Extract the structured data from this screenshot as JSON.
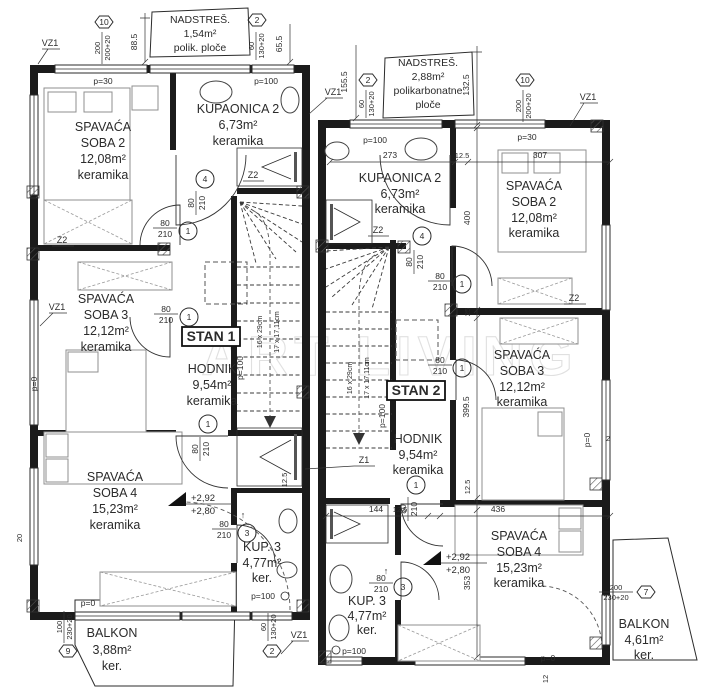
{
  "watermark": "ART LIVING",
  "stan1": {
    "label": "STAN 1",
    "nadstres": {
      "name": "NADSTREŠ.",
      "area": "1,54m²",
      "material": "polik. ploče"
    },
    "soba2": {
      "name1": "SPAVAĆA",
      "name2": "SOBA 2",
      "area": "12,08m²",
      "floor": "keramika"
    },
    "kupaonica2": {
      "name": "KUPAONICA 2",
      "area": "6,73m²",
      "floor": "keramika"
    },
    "soba3": {
      "name1": "SPAVAĆA",
      "name2": "SOBA 3",
      "area": "12,12m²",
      "floor": "keramika"
    },
    "hodnik": {
      "name": "HODNIK",
      "area": "9,54m²",
      "floor": "keramika"
    },
    "soba4": {
      "name1": "SPAVAĆA",
      "name2": "SOBA 4",
      "area": "15,23m²",
      "floor": "keramika"
    },
    "kup3": {
      "name": "KUP. 3",
      "area": "4,77m²",
      "floor": "ker."
    },
    "balkon": {
      "name": "BALKON",
      "area": "3,88m²",
      "floor": "ker."
    }
  },
  "stan2": {
    "label": "STAN 2",
    "nadstres": {
      "name": "NADSTREŠ.",
      "area": "2,88m²",
      "material1": "polikarbonatne",
      "material2": "ploče"
    },
    "kupaonica2": {
      "name": "KUPAONICA 2",
      "area": "6,73m²",
      "floor": "keramika"
    },
    "soba2": {
      "name1": "SPAVAĆA",
      "name2": "SOBA 2",
      "area": "12,08m²",
      "floor": "keramika"
    },
    "soba3": {
      "name1": "SPAVAĆA",
      "name2": "SOBA 3",
      "area": "12,12m²",
      "floor": "keramika"
    },
    "hodnik": {
      "name": "HODNIK",
      "area": "9,54m²",
      "floor": "keramika"
    },
    "soba4": {
      "name1": "SPAVAĆA",
      "name2": "SOBA 4",
      "area": "15,23m²",
      "floor": "keramika"
    },
    "kup3": {
      "name": "KUP. 3",
      "area": "4,77m²",
      "floor": "ker."
    },
    "balkon": {
      "name": "BALKON",
      "area": "4,61m²",
      "floor": "ker."
    }
  },
  "levels": {
    "upper": "+2,92",
    "lower": "+2,80"
  },
  "stairs": {
    "spec1": "16 x 29cm",
    "spec2": "17 x 17,11cm"
  },
  "door": {
    "w": "80",
    "h": "210"
  },
  "door_nums": {
    "n1": "1",
    "n3": "3",
    "n4": "4"
  },
  "hex": {
    "h10": {
      "no": "10",
      "a": "200",
      "b": "200+20"
    },
    "h2": {
      "no": "2",
      "a": "60",
      "b": "130+20"
    },
    "h9": {
      "no": "9",
      "a": "100",
      "b": "230+20"
    },
    "h7": {
      "no": "7",
      "a": "200",
      "b": "230+20"
    }
  },
  "dims": {
    "d885": "88.5",
    "d655": "65.5",
    "d1555": "155.5",
    "d1325": "132.5",
    "d273": "273",
    "d125": "12.5",
    "d307": "307",
    "d400": "400",
    "d25": "25",
    "d3995": "399.5",
    "d144": "144",
    "d436": "436",
    "d353": "353",
    "d20": "20",
    "d12": "12",
    "d2": "2"
  },
  "sills": {
    "p0": "p=0",
    "p30": "p=30",
    "p100": "p=100"
  },
  "marks": {
    "vz1": "VZ1",
    "z1": "Z1",
    "z2": "Z2"
  },
  "arrow_up": "↑"
}
